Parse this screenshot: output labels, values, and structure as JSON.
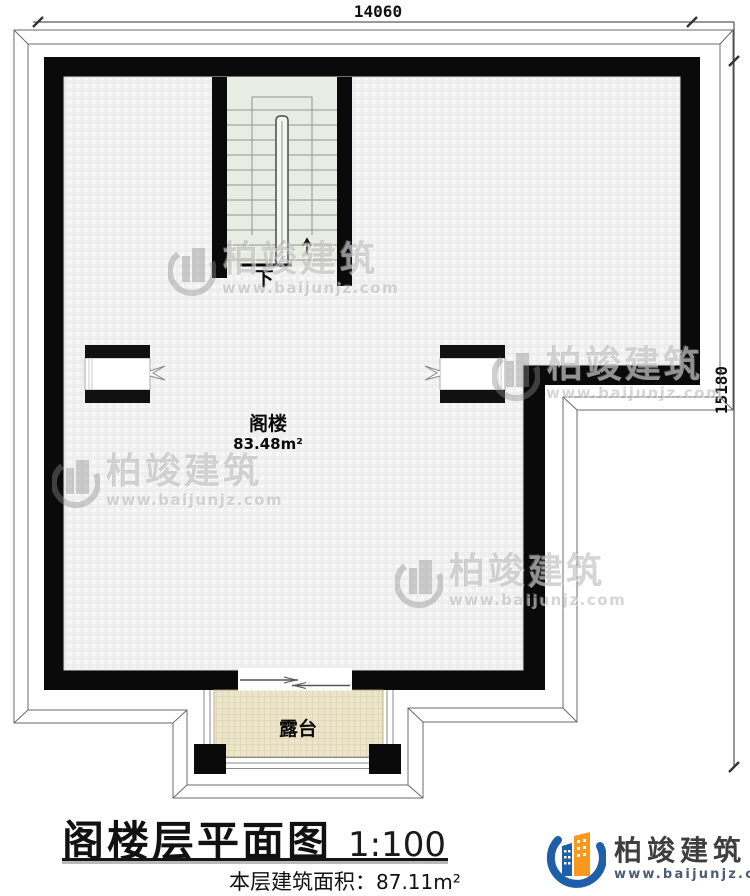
{
  "plan": {
    "dim_top": "14060",
    "dim_right": "15180",
    "room": {
      "name": "阁楼",
      "area": "83.48m²"
    },
    "stair_direction": "下",
    "terrace_label": "露台"
  },
  "titleblock": {
    "title": "阁楼层平面图",
    "scale": "1:100",
    "area_label": "本层建筑面积：",
    "area_value": "87.11m²"
  },
  "brand": {
    "name": "柏竣建筑",
    "url": "www.baijunjz.com"
  },
  "watermark": {
    "name": "柏竣建筑",
    "url": "www.baijunjz.com"
  },
  "colors": {
    "wall": "#0a0a0a",
    "stair_floor": "#e9ece3",
    "terrace_floor": "#ece5cb",
    "outline": "#555555",
    "logo_blue": "#1d5fa8",
    "logo_orange": "#f6991e",
    "logo_text": "#3e3e3e",
    "logo_url": "#4c5d73"
  }
}
